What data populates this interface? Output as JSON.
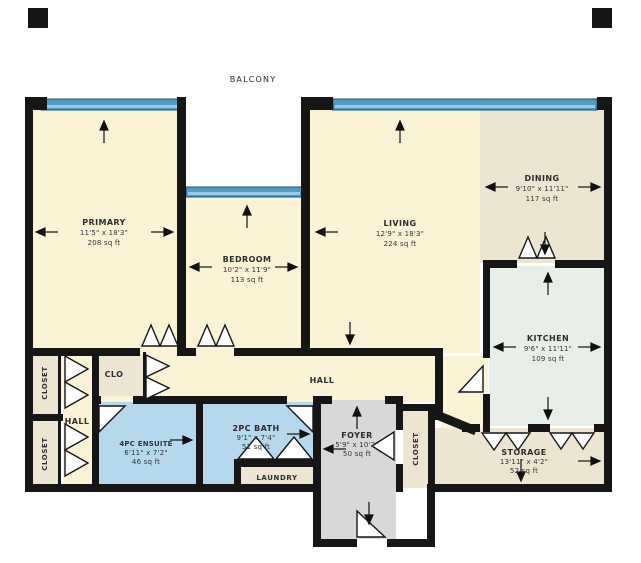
{
  "plan": {
    "balcony_label": "BALCONY",
    "colors": {
      "wall": "#161616",
      "room_cream": "#faf3d5",
      "room_beige": "#ece5d2",
      "room_mint": "#e8efe8",
      "room_blue": "#b5d8ec",
      "room_gray": "#d8d8d8",
      "window_glass": "#4f9cc6"
    },
    "rooms": {
      "primary": {
        "name": "PRIMARY",
        "dims": "11'5\" x 18'3\"",
        "area": "208 sq ft"
      },
      "bedroom": {
        "name": "BEDROOM",
        "dims": "10'2\" x 11'9\"",
        "area": "113 sq ft"
      },
      "living": {
        "name": "LIVING",
        "dims": "12'9\" x 18'3\"",
        "area": "224 sq ft"
      },
      "dining": {
        "name": "DINING",
        "dims": "9'10\" x 11'11\"",
        "area": "117 sq ft"
      },
      "kitchen": {
        "name": "KITCHEN",
        "dims": "9'6\" x 11'11\"",
        "area": "109 sq ft"
      },
      "ensuite": {
        "name": "4PC ENSUITE",
        "dims": "6'11\" x 7'2\"",
        "area": "46 sq ft"
      },
      "bath": {
        "name": "2PC BATH",
        "dims": "9'1\" x 7'4\"",
        "area": "51 sq ft"
      },
      "foyer": {
        "name": "FOYER",
        "dims": "5'9\" x 10'2\"",
        "area": "50 sq ft"
      },
      "storage": {
        "name": "STORAGE",
        "dims": "13'11\" x 4'2\"",
        "area": "52 sq ft"
      },
      "laundry": {
        "name": "LAUNDRY"
      },
      "hall": {
        "name": "HALL"
      },
      "hall2": {
        "name": "HALL"
      },
      "clo": {
        "name": "CLO"
      },
      "closet_left_upper": {
        "name": "CLOSET"
      },
      "closet_left_lower": {
        "name": "CLOSET"
      },
      "closet_foyer": {
        "name": "CLOSET"
      }
    }
  }
}
